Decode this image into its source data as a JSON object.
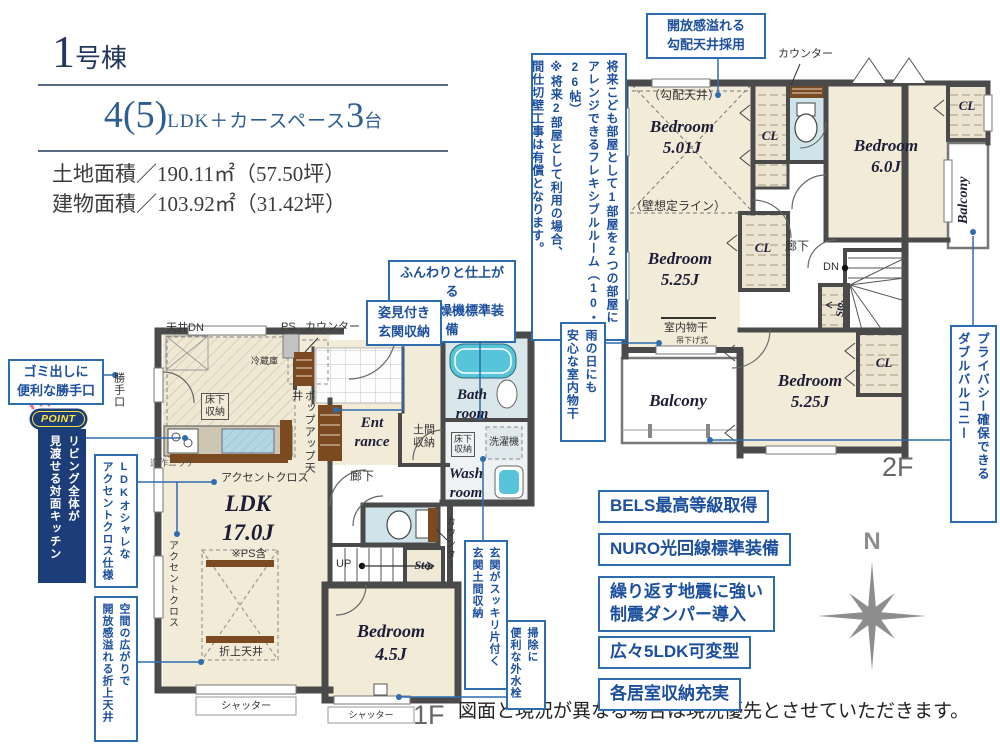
{
  "header": {
    "unit_number": "1",
    "unit_suffix": "号棟",
    "plan_count": "4(5)",
    "plan_type": "LDK＋カースペース",
    "car_count": "3",
    "car_unit": "台",
    "land_area": "土地面積／190.11㎡（57.50坪）",
    "building_area": "建物面積／103.92㎡（31.42坪）"
  },
  "floor1": {
    "floor_label": "1F",
    "ldk_name": "LDK\n17.0J",
    "ldk_note": "※PS含",
    "bedroom": "Bedroom\n4.5J",
    "entrance": "Ent\nrance",
    "bath": "Bath\nroom",
    "wash": "Wash\nroom",
    "doma": "土間\n収納",
    "hallway": "廊下",
    "up": "UP",
    "sto": "Sto.",
    "counter": "カウンター",
    "ps": "PS",
    "ceiling_dn": "天井DN",
    "fridge": "冷蔵庫",
    "floor_storage": "床下\n収納",
    "washer": "洗濯機",
    "popup_ceiling": "ポップアップ天井",
    "niche": "造作ニッチ",
    "accent_cloth": "アクセントクロス",
    "coffered_ceiling": "折上天井",
    "shutter": "シャッター",
    "back_door": "勝手口"
  },
  "floor2": {
    "floor_label": "2F",
    "counter": "カウンター",
    "sloped_ceiling": "（勾配天井）",
    "wall_line": "（壁想定ライン）",
    "bedroom_501": "Bedroom\n5.01J",
    "bedroom_60": "Bedroom\n6.0J",
    "bedroom_525a": "Bedroom\n5.25J",
    "bedroom_525b": "Bedroom\n5.25J",
    "cl": "CL",
    "balcony": "Balcony",
    "hallway": "廊下",
    "dn": "DN",
    "sto": "Sto.",
    "drying": "室内物干",
    "drying_type": "吊下げ式"
  },
  "callouts": {
    "sloped": "開放感溢れる\n勾配天井採用",
    "flexible": "将来こども部屋として1部屋を2つの部屋に\nアレンジできるフレキシブルルーム（10・26帖）\n※将来2部屋として利用の場合、\n間仕切壁工事は有償となります。",
    "indoor_drying": "雨の日にも\n安心な室内物干",
    "double_balcony": "プライバシー確保できる\nダブルバルコニー",
    "gas_dryer": "ふんわりと仕上がる\nガス乾燥機標準装備",
    "mirror_storage": "姿見付き\n玄関収納",
    "garbage_door": "ゴミ出しに\n便利な勝手口",
    "point": "POINT",
    "kitchen": "リビング全体が\n見渡せる対面キッチン",
    "accent": "LDKオシャレな\nアクセントクロス仕様",
    "coffered": "空間の広がりで\n開放感溢れる折上天井",
    "entrance_storage": "玄関がスッキリ片付く\n玄関土間収納",
    "outdoor_faucet": "掃除に\n便利な外水栓"
  },
  "features": [
    "BELS最高等級取得",
    "NURO光回線標準装備",
    "繰り返す地震に強い\n制震ダンパー導入",
    "広々5LDK可変型",
    "各居室収納充実"
  ],
  "compass": {
    "north": "N"
  },
  "disclaimer": "図面と現況が異なる場合は現況優先とさせていただきます。",
  "colors": {
    "navy": "#22365c",
    "blue": "#2e6cb0",
    "text_blue": "#1c4f9e",
    "cream": "#f1ebd8",
    "wall": "#4a4a4a",
    "aqua": "#cfe3ea",
    "brown": "#7c4a21",
    "point_navy": "#1d3d79",
    "point_yellow": "#ffe43c",
    "pink": "#f06fa0",
    "gray": "#8d8d8d"
  }
}
